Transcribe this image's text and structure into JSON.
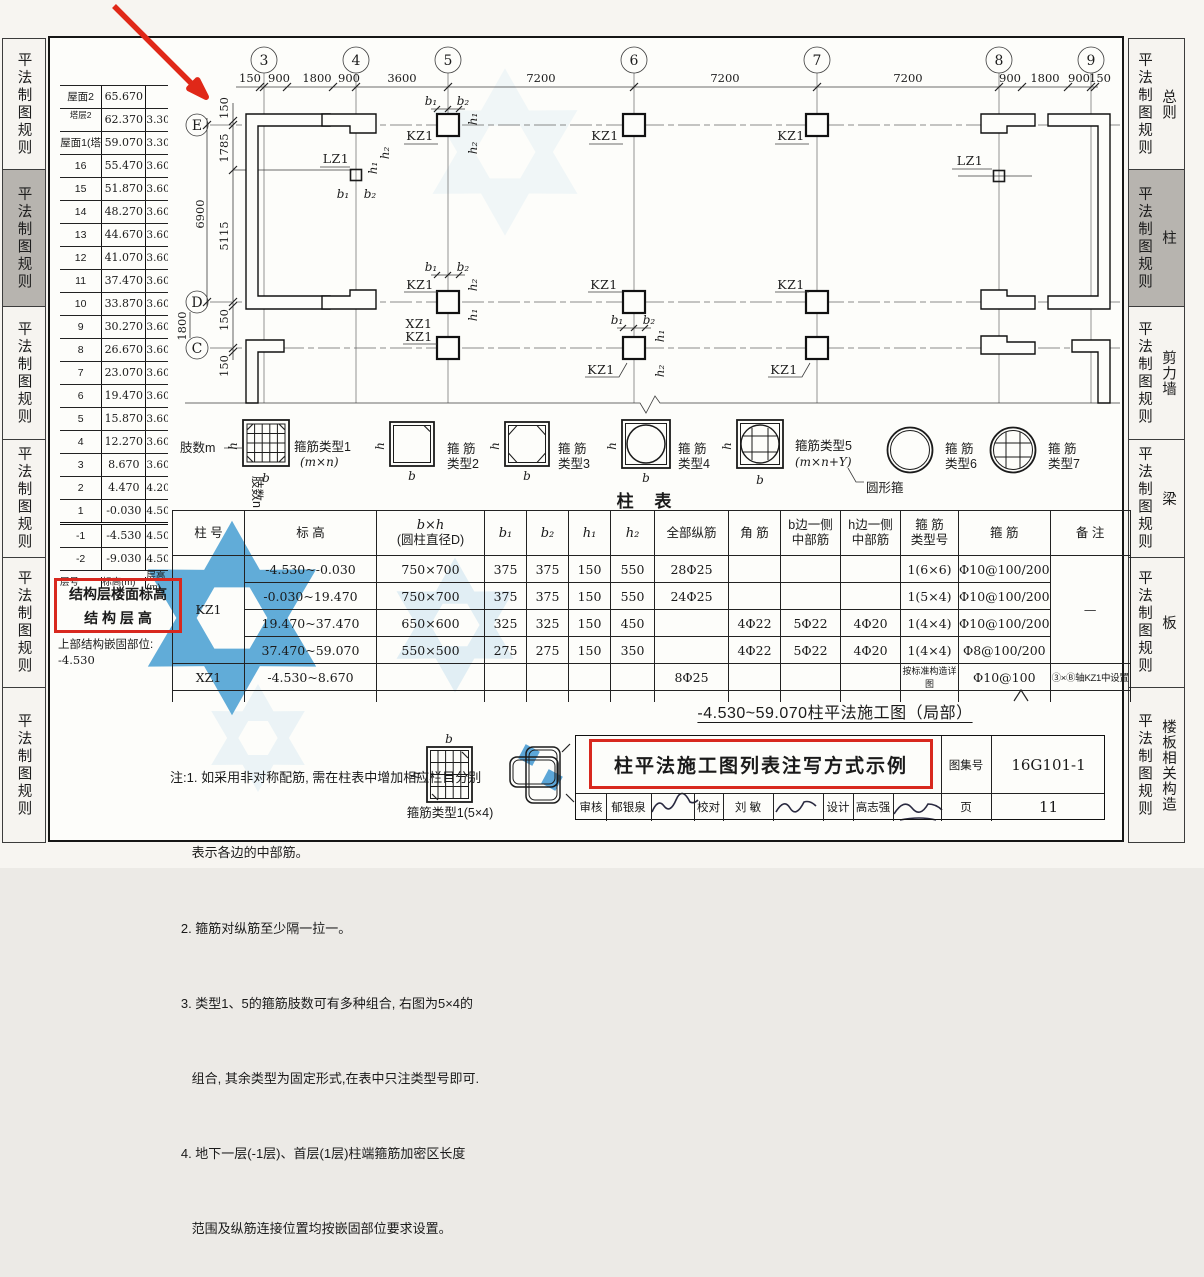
{
  "sidebar_left": {
    "items": [
      {
        "label": "平法制图规则"
      },
      {
        "label": "平法制图规则",
        "active": true
      },
      {
        "label": "平法制图规则"
      },
      {
        "label": "平法制图规则"
      },
      {
        "label": "平法制图规则"
      },
      {
        "label": "平法制图规则"
      }
    ]
  },
  "sidebar_right": {
    "items": [
      {
        "label": "平法制图规则",
        "cat": "总则"
      },
      {
        "label": "平法制图规则",
        "cat": "柱",
        "active": true
      },
      {
        "label": "平法制图规则",
        "cat": "剪力墙"
      },
      {
        "label": "平法制图规则",
        "cat": "梁"
      },
      {
        "label": "平法制图规则",
        "cat": "板"
      },
      {
        "label": "平法制图规则",
        "cat": "楼板相关构造"
      }
    ]
  },
  "floor_table": {
    "rows": [
      [
        "屋面2",
        "65.670",
        ""
      ],
      [
        "塔层2",
        "62.370",
        "3.30"
      ],
      [
        "屋面1(塔层1)",
        "59.070",
        "3.30"
      ],
      [
        "16",
        "55.470",
        "3.60"
      ],
      [
        "15",
        "51.870",
        "3.60"
      ],
      [
        "14",
        "48.270",
        "3.60"
      ],
      [
        "13",
        "44.670",
        "3.60"
      ],
      [
        "12",
        "41.070",
        "3.60"
      ],
      [
        "11",
        "37.470",
        "3.60"
      ],
      [
        "10",
        "33.870",
        "3.60"
      ],
      [
        "9",
        "30.270",
        "3.60"
      ],
      [
        "8",
        "26.670",
        "3.60"
      ],
      [
        "7",
        "23.070",
        "3.60"
      ],
      [
        "6",
        "19.470",
        "3.60"
      ],
      [
        "5",
        "15.870",
        "3.60"
      ],
      [
        "4",
        "12.270",
        "3.60"
      ],
      [
        "3",
        "8.670",
        "3.60"
      ],
      [
        "2",
        "4.470",
        "4.20"
      ],
      [
        "1",
        "-0.030",
        "4.50"
      ],
      [
        "-1",
        "-4.530",
        "4.50"
      ],
      [
        "-2",
        "-9.030",
        "4.50"
      ]
    ],
    "footer": [
      "层号",
      "标高(m)",
      "层高(m)"
    ],
    "box_line1": "结构层楼面标高",
    "box_line2": "结 构 层 高",
    "embed_label": "上部结构嵌固部位:",
    "embed_value": "-4.530"
  },
  "plan": {
    "axes": [
      "3",
      "4",
      "5",
      "6",
      "7",
      "8",
      "9"
    ],
    "rows": [
      "E",
      "D",
      "C"
    ],
    "dims_top": [
      "150",
      "900",
      "1800",
      "900",
      "3600",
      "7200",
      "7200",
      "7200",
      "900",
      "1800",
      "900",
      "150"
    ],
    "dims_left": [
      "150",
      "1785",
      "5115",
      "150",
      "150"
    ],
    "dims_outer": [
      "6900",
      "1800"
    ],
    "kz1": "KZ1",
    "xz1": "XZ1",
    "lz1": "LZ1",
    "b1": "b₁",
    "b2": "b₂",
    "h1": "h₁",
    "h2": "h₂"
  },
  "stirrups": {
    "leg_m": "肢数m",
    "leg_n": "肢数n",
    "b": "b",
    "h": "h",
    "round_note": "圆形箍",
    "items": [
      {
        "name": "箍筋类型1",
        "sub": "(m×n)"
      },
      {
        "name": "箍 筋",
        "sub": "类型2"
      },
      {
        "name": "箍 筋",
        "sub": "类型3"
      },
      {
        "name": "箍 筋",
        "sub": "类型4"
      },
      {
        "name": "箍筋类型5",
        "sub": "(m×n+Y)"
      },
      {
        "name": "箍 筋",
        "sub": "类型6"
      },
      {
        "name": "箍 筋",
        "sub": "类型7"
      }
    ],
    "type1_54": "箍筋类型1(5×4)"
  },
  "column_table": {
    "title": "柱 表",
    "headers": {
      "col": "柱 号",
      "elev": "标 高",
      "bh1": "b×h",
      "bh2": "(圆柱直径D)",
      "b1": "b₁",
      "b2": "b₂",
      "h1": "h₁",
      "h2": "h₂",
      "all": "全部纵筋",
      "corner": "角 筋",
      "bside1": "b边一侧",
      "bside2": "中部筋",
      "hside1": "h边一侧",
      "hside2": "中部筋",
      "type1": "箍 筋",
      "type2": "类型号",
      "hoop": "箍 筋",
      "remark": "备 注"
    },
    "kz1": "KZ1",
    "xz1": "XZ1",
    "rows": [
      [
        "-4.530~-0.030",
        "750×700",
        "375",
        "375",
        "150",
        "550",
        "28Φ25",
        "",
        "",
        "",
        "1(6×6)",
        "Φ10@100/200"
      ],
      [
        "-0.030~19.470",
        "750×700",
        "375",
        "375",
        "150",
        "550",
        "24Φ25",
        "",
        "",
        "",
        "1(5×4)",
        "Φ10@100/200"
      ],
      [
        "19.470~37.470",
        "650×600",
        "325",
        "325",
        "150",
        "450",
        "",
        "4Φ22",
        "5Φ22",
        "4Φ20",
        "1(4×4)",
        "Φ10@100/200"
      ],
      [
        "37.470~59.070",
        "550×500",
        "275",
        "275",
        "150",
        "350",
        "",
        "4Φ22",
        "5Φ22",
        "4Φ20",
        "1(4×4)",
        "Φ8@100/200"
      ]
    ],
    "xz1_row": [
      "-4.530~8.670",
      "",
      "",
      "",
      "",
      "",
      "8Φ25",
      "",
      "",
      "",
      "按标准构造详图",
      "Φ10@100"
    ],
    "dash": "—",
    "xz1_remark": "③×Ⓑ轴KZ1中设置"
  },
  "notes": {
    "lines": [
      "注:1. 如采用非对称配筋, 需在柱表中增加相应栏目分别",
      "      表示各边的中部筋。",
      "   2. 箍筋对纵筋至少隔一拉一。",
      "   3. 类型1、5的箍筋肢数可有多种组合, 右图为5×4的",
      "      组合, 其余类型为固定形式,在表中只注类型号即可.",
      "   4. 地下一层(-1层)、首层(1层)柱端箍筋加密区长度",
      "      范围及纵筋连接位置均按嵌固部位要求设置。"
    ]
  },
  "footer_block": {
    "caption": "-4.530~59.070柱平法施工图（局部）",
    "title": "柱平法施工图列表注写方式示例",
    "atlas_label": "图集号",
    "atlas_no": "16G101-1",
    "page_label": "页",
    "page_no": "11",
    "review_label": "审核",
    "reviewer": "郁银泉",
    "proof_label": "校对",
    "proofer": "刘 敏",
    "design_label": "设计",
    "designer": "高志强"
  },
  "colors": {
    "accent_red": "#d8281e",
    "logo_blue": "#4fa3d6",
    "tab_gray": "#b7b4af"
  }
}
